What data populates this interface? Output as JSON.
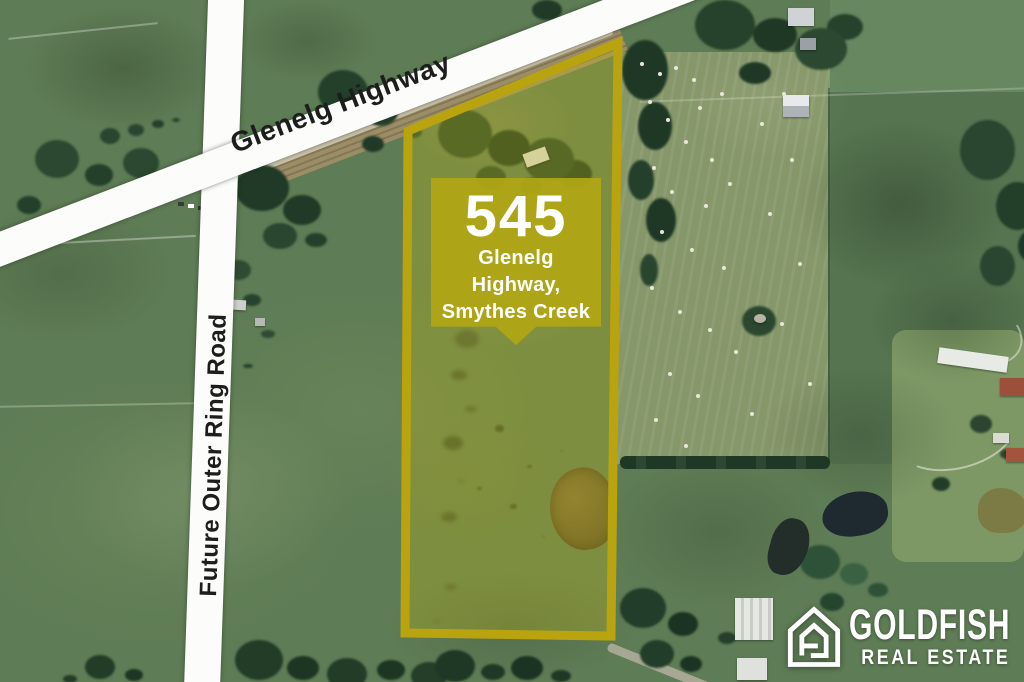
{
  "roads": {
    "highway_label": "Glenelg Highway",
    "ring_road_label": "Future Outer Ring Road"
  },
  "listing_badge": {
    "street_number": "545",
    "address_lines": [
      "Glenelg",
      "Highway,",
      "Smythes Creek"
    ]
  },
  "brand": {
    "name": "GOLDFISH",
    "tagline": "REAL ESTATE"
  },
  "colors": {
    "parcel_outline": "#b9a410",
    "parcel_fill": "rgba(210,190,10,0.28)",
    "badge_background": "rgba(176,167,20,0.93)",
    "badge_text": "#ffffff",
    "road_surface": "#fcfcfb",
    "road_label_text": "#1d1d1d",
    "brand_text": "#ffffff"
  }
}
